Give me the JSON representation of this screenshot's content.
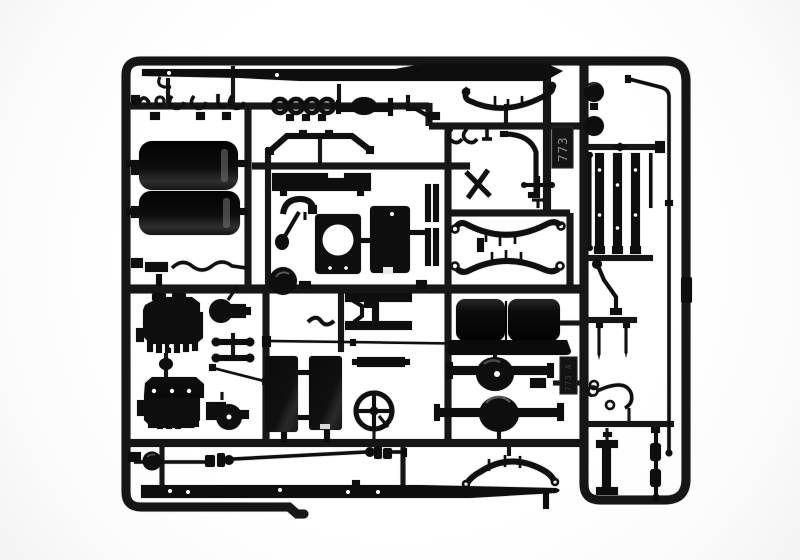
{
  "image": {
    "type": "product-photograph",
    "subject": "injection-molded model kit sprue (parts tree) of black styrene truck parts on a white background",
    "background_color": "#ffffff",
    "plastic_color": "#0e0e0e",
    "runner_color": "#161616",
    "highlight_color": "#4a4a4a"
  },
  "sprue": {
    "mold_number": "773",
    "mold_number_secondary": "773 A",
    "frames": [
      "main-frame",
      "right-frame"
    ],
    "parts": [
      {
        "id": "chassis-rail-top",
        "label": "long tapered chassis side rail"
      },
      {
        "id": "hooks-cluster",
        "label": "small hooks and shackles"
      },
      {
        "id": "mounting-rings",
        "label": "four round eyelets"
      },
      {
        "id": "axle-tube",
        "label": "axle tube with center bulge"
      },
      {
        "id": "bracket-top-right",
        "label": "angled bracket"
      },
      {
        "id": "leaf-spring-top",
        "label": "multi-leaf spring"
      },
      {
        "id": "fuel-tank-upper",
        "label": "cylindrical fuel tank"
      },
      {
        "id": "fuel-tank-lower",
        "label": "cylindrical fuel tank"
      },
      {
        "id": "front-bumper",
        "label": "bent bumper bar"
      },
      {
        "id": "step-bar",
        "label": "notched step bar"
      },
      {
        "id": "mudguard-bracket",
        "label": "bracket with arm and foot"
      },
      {
        "id": "pulley-disc",
        "label": "round pulley disc"
      },
      {
        "id": "fan-shroud-panel",
        "label": "panel with round fan opening"
      },
      {
        "id": "cab-back-panel",
        "label": "rounded rectangular panel"
      },
      {
        "id": "channel-strips",
        "label": "flat channel strips"
      },
      {
        "id": "cross-brace",
        "label": "X-shaped cross brace"
      },
      {
        "id": "exhaust-pipe",
        "label": "curved exhaust pipe"
      },
      {
        "id": "anchor-fitting",
        "label": "small cross fitting"
      },
      {
        "id": "leaf-spring-pair",
        "label": "two nested leaf springs"
      },
      {
        "id": "engine-block-upper",
        "label": "engine block half with ribs"
      },
      {
        "id": "engine-block-lower",
        "label": "engine block half with bolt holes"
      },
      {
        "id": "gearbox-upper",
        "label": "gearbox with bell housing"
      },
      {
        "id": "gearbox-lower",
        "label": "gearbox with bell housing"
      },
      {
        "id": "engine-mount-links",
        "label": "dog-bone engine mount links"
      },
      {
        "id": "linkage-rod",
        "label": "short diagonal linkage rod"
      },
      {
        "id": "battery-box-panel",
        "label": "battery box side panel"
      },
      {
        "id": "tank-side-panel",
        "label": "tank side panel"
      },
      {
        "id": "running-board-step",
        "label": "solid step bar"
      },
      {
        "id": "h-bracket",
        "label": "H-shaped bracket"
      },
      {
        "id": "s-hook",
        "label": "S-shaped hook"
      },
      {
        "id": "tie-rod",
        "label": "long thin tie rod"
      },
      {
        "id": "steering-wheel",
        "label": "steering wheel with cross spokes"
      },
      {
        "id": "bench-seat",
        "label": "two-place bench seat"
      },
      {
        "id": "rear-axle-small",
        "label": "banjo axle with differential"
      },
      {
        "id": "rear-axle-large",
        "label": "banjo axle with differential"
      },
      {
        "id": "drive-shaft",
        "label": "drive shaft with universal joints"
      },
      {
        "id": "leaf-spring-bottom",
        "label": "arched leaf spring"
      },
      {
        "id": "chassis-rail-bottom",
        "label": "long tapered chassis side rail"
      },
      {
        "id": "air-filter-drums",
        "label": "two round filter drums"
      },
      {
        "id": "frame-channel-strips",
        "label": "three straight channel strips"
      },
      {
        "id": "push-rod",
        "label": "thin push rod with ball ends"
      },
      {
        "id": "bent-long-rod",
        "label": "long bent rod"
      },
      {
        "id": "brake-lever",
        "label": "lever with bent arm"
      },
      {
        "id": "needle-pins",
        "label": "thin tapered pins"
      },
      {
        "id": "hook-with-eyelets",
        "label": "curved hook with eyelets"
      },
      {
        "id": "i-beam-bracket",
        "label": "I-section bracket"
      },
      {
        "id": "segmented-rod",
        "label": "segmented linkage rod"
      }
    ]
  }
}
